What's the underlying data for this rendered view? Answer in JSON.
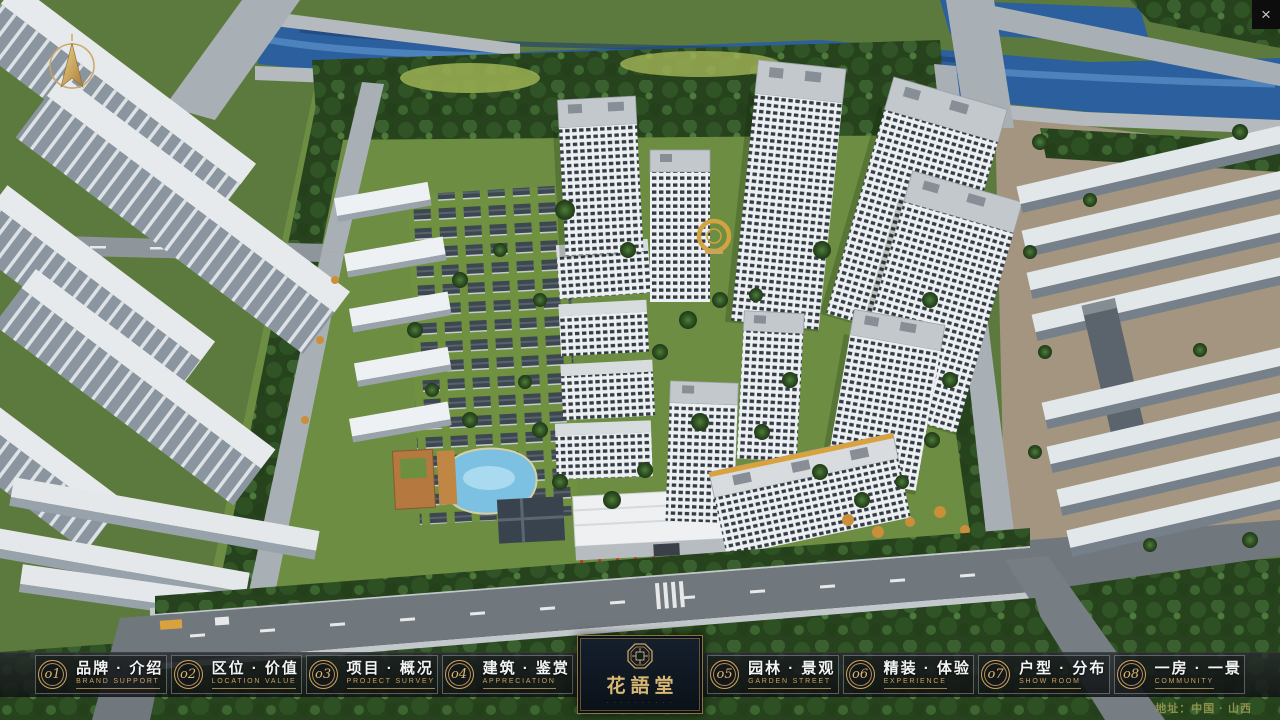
{
  "window": {
    "close_glyph": "×"
  },
  "compass": {
    "description": "gold north arrow compass"
  },
  "nav": {
    "items": [
      {
        "num": "o1",
        "zh": "品牌 · 介绍",
        "en": "BRAND SUPPORT"
      },
      {
        "num": "o2",
        "zh": "区位 · 价值",
        "en": "LOCATION VALUE"
      },
      {
        "num": "o3",
        "zh": "项目 · 概况",
        "en": "PROJECT SURVEY"
      },
      {
        "num": "o4",
        "zh": "建筑 · 鉴赏",
        "en": "APPRECIATION"
      },
      {
        "num": "o5",
        "zh": "园林 · 景观",
        "en": "GARDEN STREET"
      },
      {
        "num": "o6",
        "zh": "精装 · 体验",
        "en": "EXPERIENCE"
      },
      {
        "num": "o7",
        "zh": "户型 · 分布",
        "en": "SHOW ROOM"
      },
      {
        "num": "o8",
        "zh": "一房 · 一景",
        "en": "COMMUNITY"
      }
    ]
  },
  "logo": {
    "title": "花語堂",
    "tagline": "· · · · · · · · · ·"
  },
  "footer": {
    "address": "地址：中国 · 山西"
  },
  "colors": {
    "gold": "#c9a35f",
    "bar_background": "#1b1d1f",
    "logo_panel": "#0e1726",
    "river_blue": "#2c5f9e",
    "flag_red": "#cc2b22",
    "address_olive": "#93934d"
  }
}
